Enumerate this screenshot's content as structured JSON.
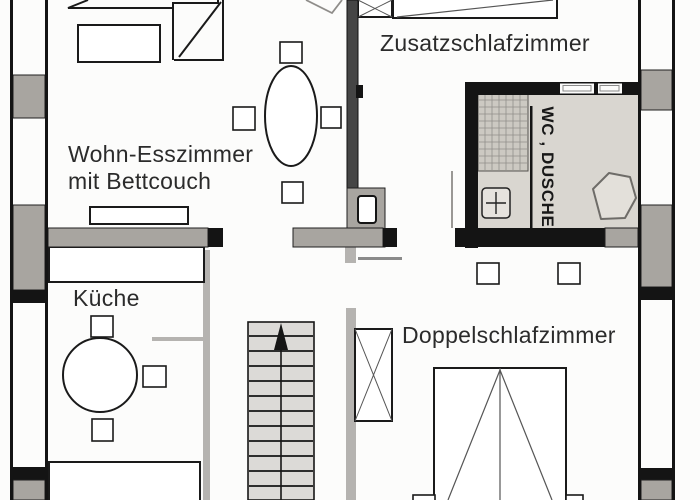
{
  "labels": {
    "living_room_line1": "Wohn-Esszimmer",
    "living_room_line2": "mit Bettcouch",
    "kitchen": "Küche",
    "extra_bedroom": "Zusatzschlafzimmer",
    "double_bedroom": "Doppelschlafzimmer",
    "bathroom": "WC , DUSCHE"
  },
  "colors": {
    "wall_black": "#141414",
    "wall_dark": "#454545",
    "wall_gray": "#a8a5a0",
    "partition_gray": "#b5b3b0",
    "floor_gray": "#d9d6d0",
    "tile_gray": "#ccc9c2",
    "stair_gray": "#dcdad7",
    "furniture_line": "#1a1a1a",
    "light_line": "#8f8d8a",
    "text_color": "#2b2b2b"
  }
}
